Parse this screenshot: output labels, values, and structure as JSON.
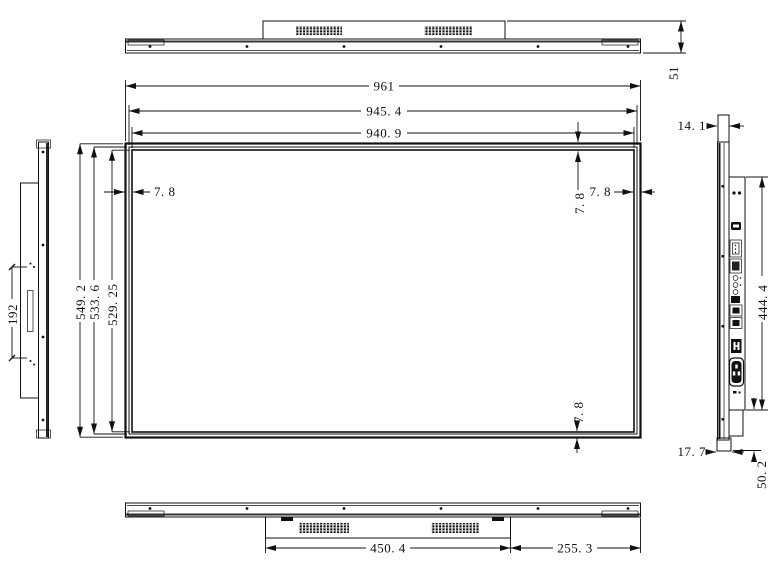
{
  "colors": {
    "line": "#111111",
    "background": "#ffffff"
  },
  "dims": {
    "top_height": "51",
    "width_outer": "961",
    "width_frame": "945. 4",
    "width_display": "940. 9",
    "height_outer": "549. 2",
    "height_frame": "533. 6",
    "height_display": "529. 25",
    "bezel_left": "7. 8",
    "bezel_right": "7. 8",
    "bezel_top": "7. 8",
    "bezel_bottom": "7. 8",
    "side_thickness": "14. 1",
    "handle_slot_length": "192",
    "back_panel_height": "444. 4",
    "bottom_edge_thickness": "17. 7",
    "bottom_section_height": "50. 2",
    "vent_box_width": "450. 4",
    "vent_box_right_offset": "255. 3"
  }
}
